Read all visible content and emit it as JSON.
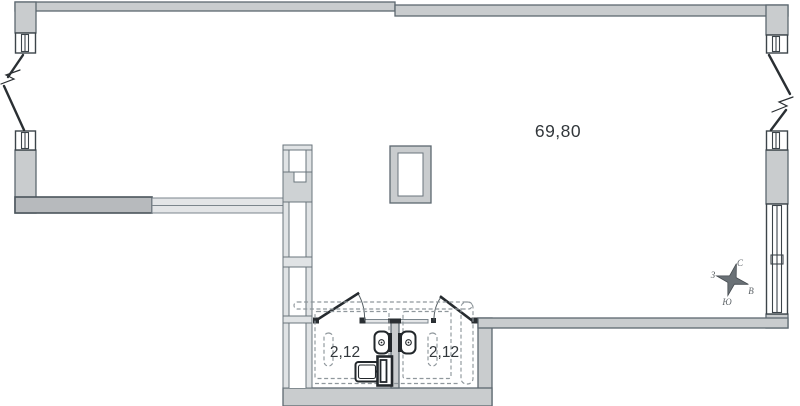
{
  "plan": {
    "type": "apartment-floor-plan",
    "labels": {
      "main_area": "69,80",
      "bathroom_left_area": "2,12",
      "bathroom_right_area": "2,12"
    },
    "compass": {
      "north": "С",
      "east": "В",
      "south": "Ю",
      "west": "З"
    },
    "colors": {
      "wall_fill": "#c9ccce",
      "wall_stroke": "#5d6870",
      "thick_wall_fill": "#b7babd",
      "partition_fill": "#e3e5e7",
      "dashed_stroke": "#8f979c",
      "fixture_stroke": "#22272b",
      "text_color": "#32373b",
      "background": "#ffffff"
    }
  }
}
